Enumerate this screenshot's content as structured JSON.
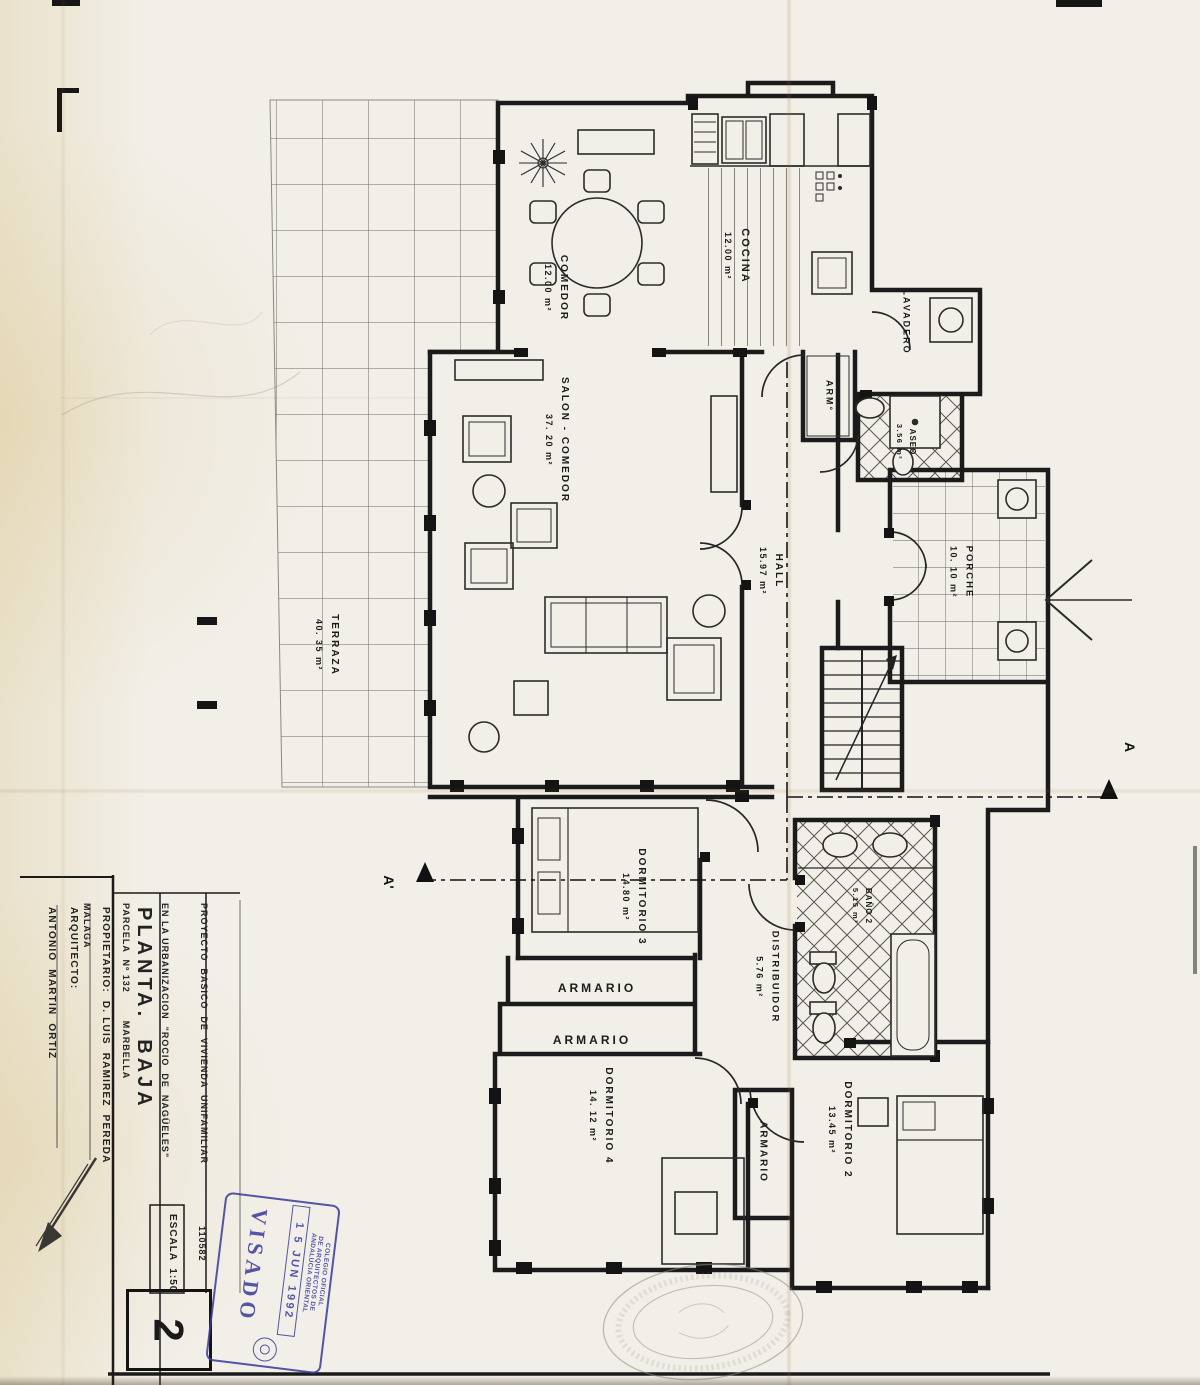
{
  "document": {
    "type": "scanned architectural floor plan",
    "ink_color": "#1b1b1b",
    "paper_color": "#f2efe8",
    "stamp_color": "#3d3f9e"
  },
  "rooms": [
    {
      "name": "COCINA",
      "area": "12.00 m²"
    },
    {
      "name": "COMEDOR",
      "area": "12.00 m²"
    },
    {
      "name": "SALON - COMEDOR",
      "area": "37. 20 m²"
    },
    {
      "name": "TERRAZA",
      "area": "40. 35 m²"
    },
    {
      "name": "HALL",
      "area": "15.97 m²"
    },
    {
      "name": "PORCHE",
      "area": "10. 10 m²"
    },
    {
      "name": "LAVADERO",
      "area": ""
    },
    {
      "name": "ARM°",
      "area": ""
    },
    {
      "name": "ASEO",
      "area": "3.56 m²"
    },
    {
      "name": "DORMITORIO 3",
      "area": "14.80 m²"
    },
    {
      "name": "DISTRIBUIDOR",
      "area": "5.76 m²"
    },
    {
      "name": "BAÑO 2",
      "area": "5.15 m²"
    },
    {
      "name": "ARMARIO",
      "area": ""
    },
    {
      "name": "ARMARIO",
      "area": ""
    },
    {
      "name": "DORMITORIO 4",
      "area": "14. 12 m²"
    },
    {
      "name": "ARMARIO",
      "area": ""
    },
    {
      "name": "DORMITORIO 2",
      "area": "13.45 m²"
    }
  ],
  "sections": {
    "a": "A",
    "a_prime": "A'"
  },
  "title_block": {
    "project_line1": "PROYECTO  BASICO  DE  VIVIENDA  UNIFAMILIAR",
    "project_line2": "EN LA URBANIZACION  \"ROCIO  DE  NAGÜELES\"",
    "project_line3": "PARCELA  Nº 132        MARBELLA",
    "project_line4": "MALAGA",
    "plan_title": "PLANTA.  BAJA",
    "owner": "PROPIETARIO:  D. LUIS  RAMIREZ  PEREDA",
    "architect_label": "ARQUITECTO:",
    "architect_name": "ANTONIO  MARTIN  ORTIZ",
    "scale": "ESCALA  1:50",
    "file_number": "110582",
    "sheet_number": "2"
  },
  "stamp": {
    "org_line1": "COLEGIO OFICIAL",
    "org_line2": "DE ARQUITECTOS DE",
    "org_line3": "ANDALUCIA ORIENTAL",
    "date": "1 5  JUN  1992",
    "visado": "VISADO"
  }
}
